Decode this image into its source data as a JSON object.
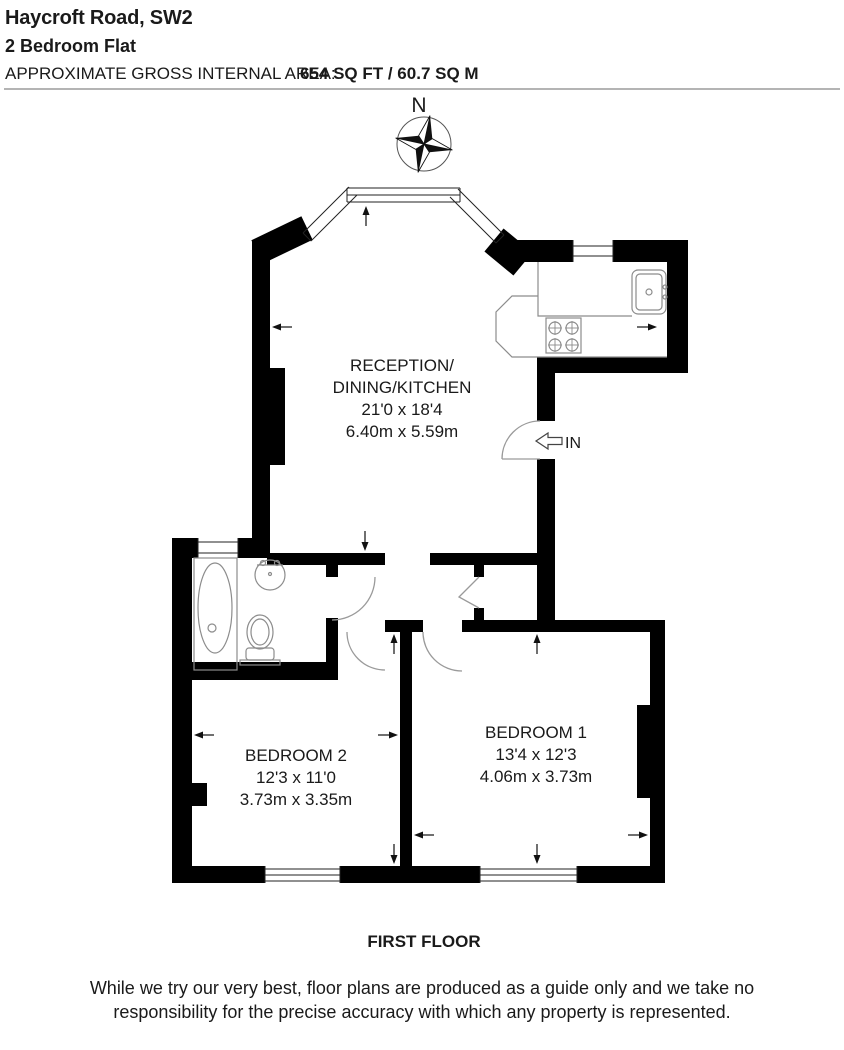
{
  "header": {
    "title": "Haycroft Road, SW2",
    "subtitle": "2 Bedroom Flat",
    "area_label": "APPROXIMATE GROSS INTERNAL AREA:",
    "area_value": "654 SQ FT / 60.7 SQ M"
  },
  "compass": {
    "north_label": "N"
  },
  "rooms": {
    "reception": {
      "name_line1": "RECEPTION/",
      "name_line2": "DINING/KITCHEN",
      "dims_imperial": "21'0 x 18'4",
      "dims_metric": "6.40m x 5.59m"
    },
    "bedroom1": {
      "name": "BEDROOM 1",
      "dims_imperial": "13'4 x 12'3",
      "dims_metric": "4.06m x 3.73m"
    },
    "bedroom2": {
      "name": "BEDROOM 2",
      "dims_imperial": "12'3 x 11'0",
      "dims_metric": "3.73m x 3.35m"
    }
  },
  "entrance": {
    "label": "IN"
  },
  "floor_label": "FIRST FLOOR",
  "disclaimer": {
    "line1": "While we try our very best, floor plans are produced as a guide only and we take no",
    "line2": "responsibility for the precise accuracy with which any property is represented."
  },
  "colors": {
    "wall": "#000000",
    "door_line": "#9a9a9a",
    "fixture_line": "#8c8c8c",
    "text": "#1a1a1a"
  }
}
